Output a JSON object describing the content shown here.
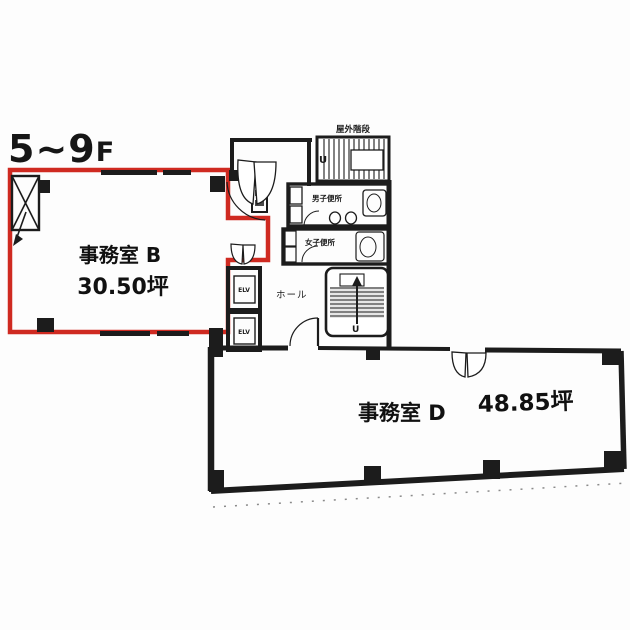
{
  "floor_label": {
    "main": "5~9",
    "suffix": "F"
  },
  "rooms": {
    "office_b": {
      "name": "事務室 B",
      "area": "30.50坪"
    },
    "office_d": {
      "name": "事務室 D",
      "area": "48.85坪"
    }
  },
  "core": {
    "hall_label": "ホール",
    "elevator_1": "ELV",
    "elevator_2": "ELV",
    "mens_toilet": "男子便所",
    "womens_toilet": "女子便所",
    "outdoor_stairs": "屋外階段",
    "stair_up_outdoor": "U",
    "stair_up_internal": "U"
  },
  "colors": {
    "outline_red": "#cf2a21",
    "line_black": "#1c1c1c",
    "background": "#ffffff"
  }
}
